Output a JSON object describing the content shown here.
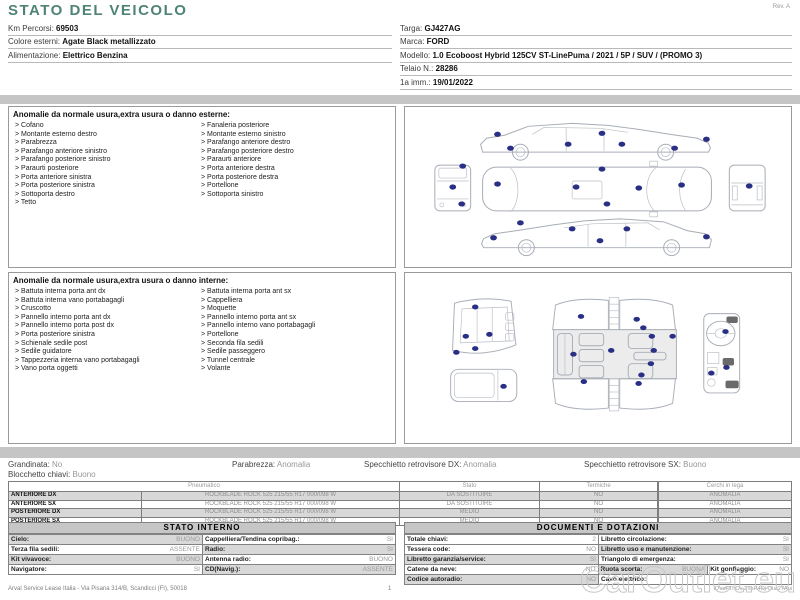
{
  "colors": {
    "accent": "#4f8376",
    "marker": "#2a2f86",
    "shade": "#d8d8d8",
    "bar": "#c5c5c5"
  },
  "header": {
    "title": "STATO DEL VEICOLO",
    "rev": "Rev. A",
    "left": [
      {
        "label": "Km Percorsi:",
        "value": "69503"
      },
      {
        "label": "Colore esterni:",
        "value": "Agate Black metallizzato"
      },
      {
        "label": "Alimentazione:",
        "value": "Elettrico Benzina"
      }
    ],
    "right": [
      {
        "label": "Targa:",
        "value": "GJ427AG"
      },
      {
        "label": "Marca:",
        "value": "FORD"
      },
      {
        "label": "Modello:",
        "value": "1.0 Ecoboost Hybrid 125CV ST-LinePuma / 2021 / 5P / SUV / (PROMO 3)"
      },
      {
        "label": "Telaio N.:",
        "value": "28286"
      },
      {
        "label": "1a imm.:",
        "value": "19/01/2022"
      }
    ]
  },
  "exterior": {
    "title": "Anomalie da normale usura,extra usura o danno esterne:",
    "col1": [
      "Cofano",
      "Montante esterno destro",
      "Parabrezza",
      "Parafango anteriore sinistro",
      "Parafango posteriore sinistro",
      "Paraurti posteriore",
      "Porta anteriore sinistra",
      "Porta posteriore sinistra",
      "Sottoporta destro",
      "Tetto"
    ],
    "col2": [
      "Fanaleria posteriore",
      "Montante esterno sinistro",
      "Parafango anteriore destro",
      "Parafango posteriore destro",
      "Paraurti anteriore",
      "Porta anteriore destra",
      "Porta posteriore destra",
      "Portellone",
      "Sottoporta sinistro"
    ]
  },
  "interior": {
    "title": "Anomalie da normale usura,extra usura o danno interne:",
    "col1": [
      "Battuta interna porta ant dx",
      "Battuta interna vano portabagagli",
      "Cruscotto",
      "Pannello interno porta ant dx",
      "Pannello interno porta post dx",
      "Porta posteriore sinistra",
      "Schienale sedile post",
      "Sedile guidatore",
      "Tappezzeria interna vano portabagagli",
      "Vano porta oggetti"
    ],
    "col2": [
      "Battuta interna porta ant sx",
      "Cappelliera",
      "Moquette",
      "Pannello interno porta ant sx",
      "Pannello interno vano portabagagli",
      "Portellone",
      "Seconda fila sedili",
      "Sedile passeggero",
      "Tunnel centrale",
      "Volante"
    ]
  },
  "diagram_markers": {
    "exterior": [
      [
        93,
        27
      ],
      [
        106,
        41
      ],
      [
        164,
        37
      ],
      [
        198,
        26
      ],
      [
        218,
        37
      ],
      [
        271,
        41
      ],
      [
        303,
        32
      ],
      [
        93,
        77
      ],
      [
        172,
        80
      ],
      [
        198,
        62
      ],
      [
        203,
        97
      ],
      [
        235,
        81
      ],
      [
        278,
        78
      ],
      [
        58,
        59
      ],
      [
        48,
        80
      ],
      [
        57,
        97
      ],
      [
        346,
        79
      ],
      [
        89,
        131
      ],
      [
        116,
        116
      ],
      [
        168,
        122
      ],
      [
        196,
        134
      ],
      [
        223,
        122
      ],
      [
        303,
        130
      ]
    ],
    "interior": [
      [
        64,
        36
      ],
      [
        54,
        67
      ],
      [
        79,
        65
      ],
      [
        44,
        84
      ],
      [
        64,
        80
      ],
      [
        94,
        120
      ],
      [
        176,
        46
      ],
      [
        235,
        49
      ],
      [
        242,
        58
      ],
      [
        251,
        67
      ],
      [
        273,
        67
      ],
      [
        168,
        86
      ],
      [
        208,
        82
      ],
      [
        253,
        82
      ],
      [
        250,
        96
      ],
      [
        240,
        108
      ],
      [
        179,
        115
      ],
      [
        237,
        117
      ],
      [
        329,
        62
      ],
      [
        330,
        100
      ],
      [
        314,
        106
      ]
    ]
  },
  "status_line": [
    {
      "label": "Grandinata:",
      "value": "No",
      "x": 8
    },
    {
      "label": "Parabrezza:",
      "value": "Anomalia",
      "x": 232
    },
    {
      "label": "Specchietto retrovisore DX:",
      "value": "Anomalia",
      "x": 364
    },
    {
      "label": "Specchietto retrovisore SX:",
      "value": "Buono",
      "x": 584
    }
  ],
  "status_line2": {
    "label": "Blocchetto chiavi:",
    "value": "Buono"
  },
  "tyres": {
    "headers": [
      "Pneumatico",
      "Stato",
      "Termiche",
      "Cerchi in lega"
    ],
    "rows": [
      {
        "pos": "ANTERIORE DX",
        "tyre": "ROCKBLADE ROCK 525 215/55 R17 000/098 W",
        "stato": "DA SOSTITUIRE",
        "termiche": "NO",
        "cerchi": "ANOMALIA",
        "shaded": true
      },
      {
        "pos": "ANTERIORE SX",
        "tyre": "ROCKBLADE ROCK 525 215/55 R17 000/098 W",
        "stato": "DA SOSTITUIRE",
        "termiche": "NO",
        "cerchi": "ANOMALIA",
        "shaded": false
      },
      {
        "pos": "POSTERIORE DX",
        "tyre": "ROCKBLADE ROCK 525 215/55 R17 000/098 W",
        "stato": "MEDIO",
        "termiche": "NO",
        "cerchi": "ANOMALIA",
        "shaded": true
      },
      {
        "pos": "POSTERIORE SX",
        "tyre": "ROCKBLADE ROCK 525 215/55 R17 000/098 W",
        "stato": "MEDIO",
        "termiche": "NO",
        "cerchi": "ANOMALIA",
        "shaded": false
      }
    ]
  },
  "stato_interno": {
    "title": "STATO INTERNO",
    "rows": [
      [
        {
          "l": "Cielo:",
          "v": "BUONO",
          "sh": true
        },
        {
          "l": "Cappelliera/Tendina copribag.:",
          "v": "SI",
          "sh": false
        }
      ],
      [
        {
          "l": "Terza fila sedili:",
          "v": "ASSENTE",
          "sh": false
        },
        {
          "l": "Radio:",
          "v": "SI",
          "sh": true
        }
      ],
      [
        {
          "l": "Kit vivavoce:",
          "v": "BUONO",
          "sh": true
        },
        {
          "l": "Antenna radio:",
          "v": "BUONO",
          "sh": false
        }
      ],
      [
        {
          "l": "Navigatore:",
          "v": "SI",
          "sh": false
        },
        {
          "l": "CD(Navig.):",
          "v": "ASSENTE",
          "sh": true
        }
      ]
    ]
  },
  "documenti": {
    "title": "DOCUMENTI E DOTAZIONI",
    "rows": [
      [
        {
          "l": "Totale chiavi:",
          "v": "2",
          "sh": false
        },
        {
          "l": "Libretto circolazione:",
          "v": "SI",
          "sh": false
        }
      ],
      [
        {
          "l": "Tessera code:",
          "v": "NO",
          "sh": false
        },
        {
          "l": "Libretto uso e manutenzione:",
          "v": "SI",
          "sh": true
        }
      ],
      [
        {
          "l": "Libretto garanzia/service:",
          "v": "SI",
          "sh": true
        },
        {
          "l": "Triangolo di emergenza:",
          "v": "SI",
          "sh": false
        }
      ],
      [
        {
          "l": "Catene da neve:",
          "v": "NO",
          "sh": false
        },
        {
          "l": "Ruota scorta:",
          "v": "BUONA",
          "sh": true,
          "w": 110
        },
        {
          "l": "Kit gonfiaggio:",
          "v": "NO",
          "sh": false,
          "w": 84
        }
      ],
      [
        {
          "l": "Codice autoradio:",
          "v": "NO",
          "sh": true
        },
        {
          "l": "Cavo elettrico:",
          "v": "",
          "sh": false
        }
      ]
    ]
  },
  "footer": {
    "left": "Arval Service Lease Italia - Via Pisana 314/B, Scandicci (FI), 50018",
    "page": "1",
    "id": "ID'ssFThOv 2'ssH4Oj Oua27Aui"
  },
  "watermark": "CarOutlet.eu"
}
